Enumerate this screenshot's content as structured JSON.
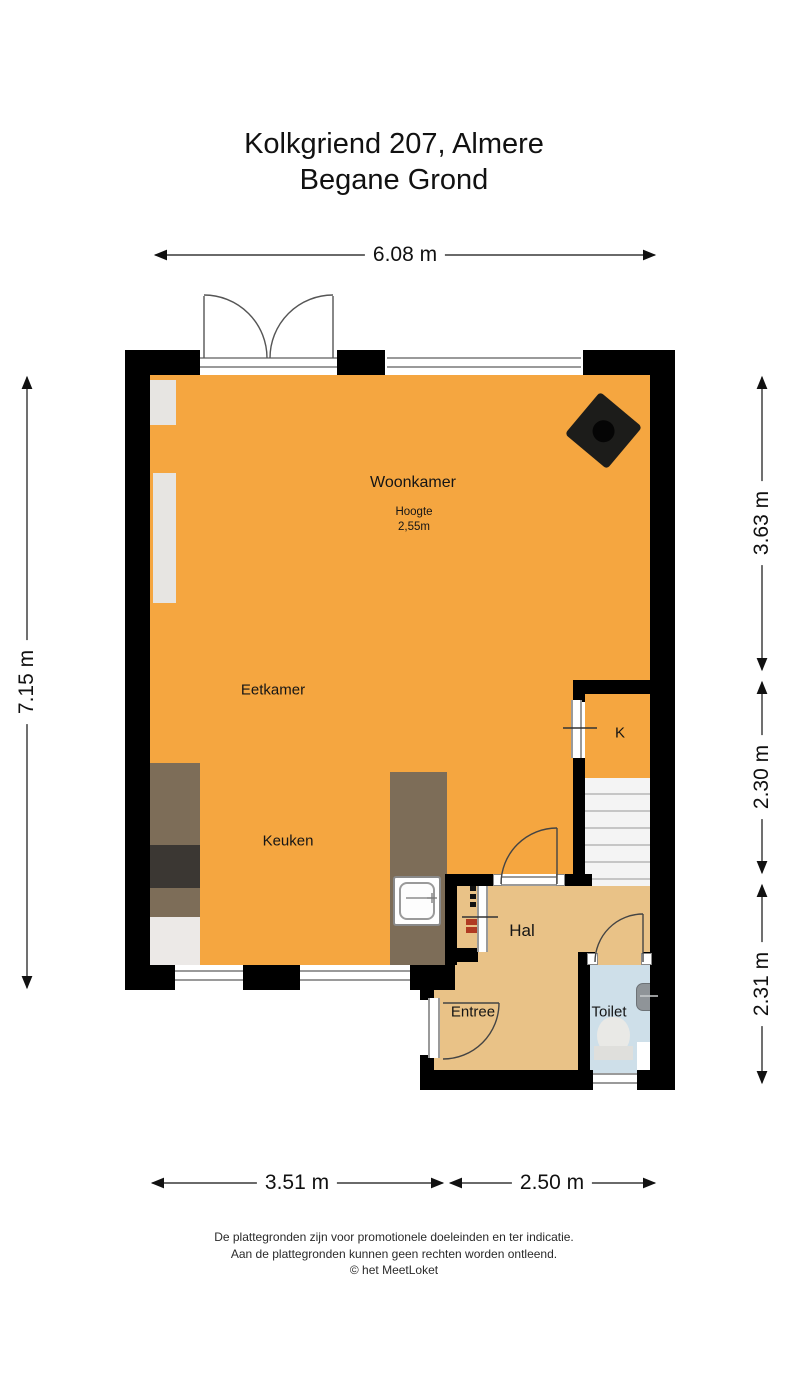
{
  "title": {
    "line1": "Kolkgriend 207, Almere",
    "line2": "Begane Grond"
  },
  "dimensions": {
    "top": "6.08 m",
    "left": "7.15 m",
    "right": [
      "3.63 m",
      "2.30 m",
      "2.31 m"
    ],
    "bottom": [
      "3.51 m",
      "2.50 m"
    ]
  },
  "rooms": {
    "woonkamer": {
      "label": "Woonkamer",
      "height_label": "Hoogte",
      "height_value": "2,55m"
    },
    "eetkamer": {
      "label": "Eetkamer"
    },
    "keuken": {
      "label": "Keuken"
    },
    "kast": {
      "label": "K"
    },
    "hal": {
      "label": "Hal"
    },
    "entree": {
      "label": "Entree"
    },
    "toilet": {
      "label": "Toilet"
    }
  },
  "footer": {
    "line1": "De plattegronden zijn voor promotionele doeleinden en ter indicatie.",
    "line2": "Aan de plattegronden kunnen geen rechten worden ontleend.",
    "line3": "© het MeetLoket"
  },
  "colors": {
    "floor_main": "#F5A640",
    "floor_hall": "#E9C287",
    "floor_toilet": "#CEDFE9",
    "wall": "#000000",
    "counter": "#7D6D58",
    "counter_dark": "#3B3733",
    "meter_marks": "#B03A22"
  }
}
